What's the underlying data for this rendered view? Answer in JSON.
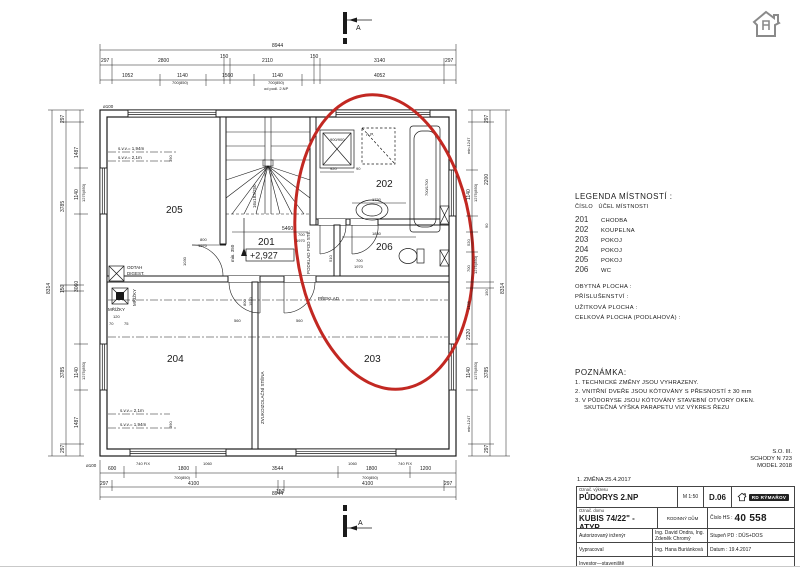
{
  "plan": {
    "section_label": "A",
    "rooms": {
      "r201": "201",
      "r202": "202",
      "r203": "203",
      "r204": "204",
      "r205": "205",
      "r206": "206"
    },
    "level": "+2,927",
    "fixtures": {
      "shower": "900/900",
      "bath": "700/1700",
      "ap": "A.P."
    },
    "annot": {
      "odtah1": "ODTAH",
      "odtah2": "DIGEST.",
      "mrizky": "MŘÍŽKY",
      "mrizky2": "MŘÍŽKY",
      "preklad": "PŘEKLAD",
      "zvuk": "ZVUKOIZOLAČNÍ STĚNA",
      "stairs": "16x183/250",
      "min350": "min. 350",
      "svv194": "s.v.v.= 1,94m",
      "svv21": "s.v.v.= 2,1m",
      "svv21b": "s.v.v.= 2,1m",
      "svv194b": "s.v.v.= 1,94m",
      "podklad": "PODKLAD POD STĚ.",
      "d100": "ø100",
      "d100b": "ø100",
      "odpodl": "od podl. 2.NP"
    },
    "dims": {
      "t1": "8944",
      "t2": [
        "297",
        "2800",
        "150",
        "2110",
        "150",
        "3140",
        "297"
      ],
      "t3": [
        "1052",
        "1140",
        "700(850)",
        "1560",
        "1140",
        "700(850)",
        "4052"
      ],
      "b0": [
        "740 FIX",
        "1060",
        "1060",
        "740 FIX"
      ],
      "b1": [
        "600",
        "1800",
        "700(850)",
        "3544",
        "1800",
        "700(850)",
        "1200"
      ],
      "b2": [
        "297",
        "4100",
        "150",
        "4100",
        "297"
      ],
      "b3": "8944",
      "l1": [
        "1487",
        "1140",
        "1275(850)",
        "3060",
        "1140",
        "1275(850)",
        "1487"
      ],
      "l2": [
        "297",
        "3785",
        "150",
        "3785",
        "297"
      ],
      "l3": "8314",
      "r1": [
        "min.1247",
        "1140",
        "1275(850)",
        "520",
        "700",
        "1275(850)",
        "1485",
        "2320",
        "1140",
        "1275(850)",
        "min.1247"
      ],
      "r2": [
        "297",
        "2200",
        "90",
        "150",
        "3785",
        "297"
      ],
      "r3": "8314",
      "i5460": "5460",
      "i920": "920",
      "i90": "90",
      "i1750": "1750",
      "i1850": "1850",
      "d205a": "800",
      "d205b": "1970",
      "d202a": "700",
      "d202b": "1970",
      "d206a": "700",
      "d206b": "1970",
      "d204a": "800",
      "d204b": "1970",
      "i1030": "1030",
      "i560a": "560",
      "i560b": "560",
      "i510": "510",
      "i390a": "390",
      "i390b": "390",
      "i120": "120",
      "i70": "70",
      "i75": "75"
    }
  },
  "legend": {
    "title": "LEGENDA MÍSTNOSTÍ :",
    "head_num": "ČÍSLO",
    "head_name": "ÚČEL MÍSTNOSTI",
    "rows": [
      {
        "num": "201",
        "name": "CHODBA"
      },
      {
        "num": "202",
        "name": "KOUPELNA"
      },
      {
        "num": "203",
        "name": "POKOJ"
      },
      {
        "num": "204",
        "name": "POKOJ"
      },
      {
        "num": "205",
        "name": "POKOJ"
      },
      {
        "num": "206",
        "name": "WC"
      }
    ],
    "areas": [
      "OBYTNÁ PLOCHA :",
      "PŘÍSLUŠENSTVÍ :",
      "UŽITKOVÁ PLOCHA :",
      "CELKOVÁ PLOCHA (PODLAHOVÁ) :"
    ]
  },
  "notes": {
    "title": "POZNÁMKA:",
    "n1": "1.  TECHNICKÉ ZMĚNY JSOU VYHRAZENY.",
    "n2": "2.  VNITŘNÍ DVEŘE JSOU KÓTOVÁNY S PŘESNOSTÍ ± 30 mm",
    "n3": "3.  V PŮDORYSE JSOU KÓTOVÁNY STAVEBNÍ OTVORY OKEN.",
    "n3b": "SKUTEČNÁ VÝŠKA PARAPETU VIZ VÝKRES ŘEZU"
  },
  "corner": {
    "l1": "S.O. III.",
    "l2": "SCHODY N 723",
    "l3": "MODEL 2018"
  },
  "change": "1. ZMĚNA 25.4.2017",
  "titleblock": {
    "f1_label": "Označ. výkresu",
    "f1_value": "PŮDORYS 2.NP",
    "scale": "M 1:50",
    "code": "D.06",
    "brand": "RD RÝMAŘOV",
    "f2_label": "Označ. domu",
    "f2_value": "KUBIS 74/22\" - ATYP",
    "type": "RODINNÝ DŮM",
    "hs_label": "Číslo HS :",
    "hs_value": "40 558",
    "r3_label": "Autorizovaný inženýr",
    "r3_value": "Ing. David Ondra, Ing. Zdeněk Chromý",
    "r3_right": "Stupeň PD : DÚS+DOS",
    "r4_label": "Vypracoval",
    "r4_value": "Ing. Hana Buriánková",
    "r4_right": "Datum :  19.4.2017",
    "r5_label": "Investor—staveniště"
  },
  "colors": {
    "line": "#1a1a1a",
    "highlight": "#c22822"
  }
}
